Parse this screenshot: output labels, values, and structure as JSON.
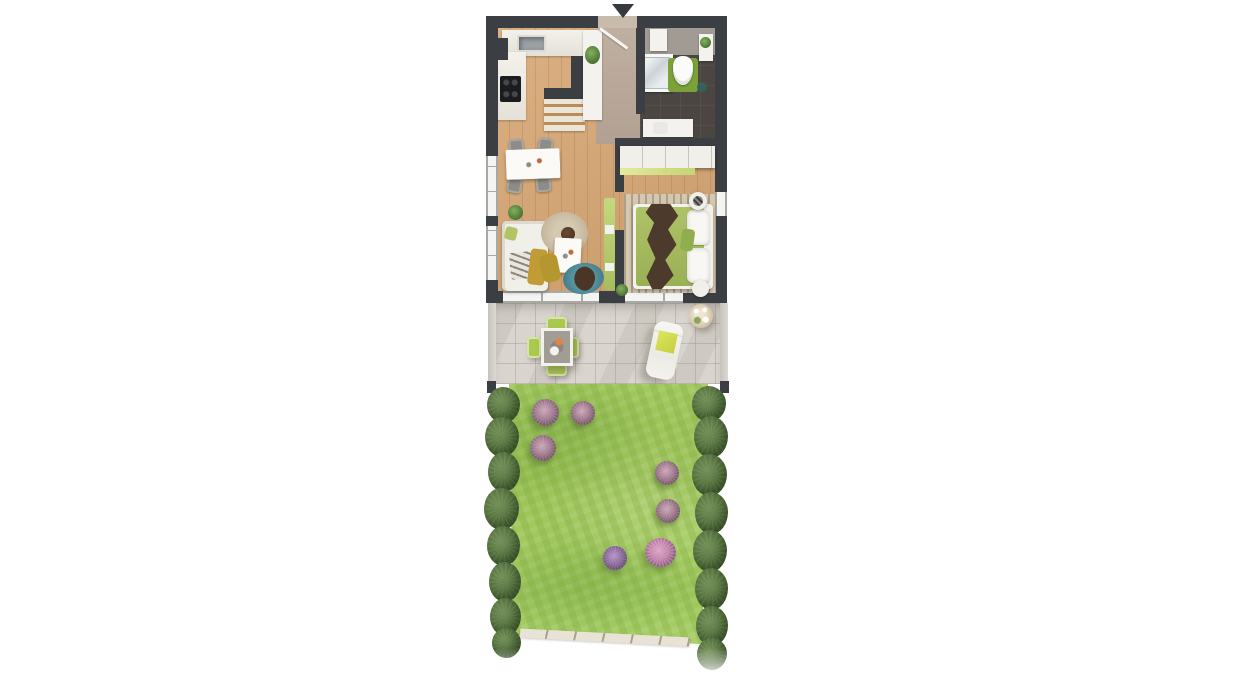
{
  "meta": {
    "kind": "floor-plan-render",
    "visible_text": "none",
    "canvas": {
      "width": 1236,
      "height": 700,
      "background": "#ffffff"
    }
  },
  "palette": {
    "wall": "#3b3e42",
    "wood_floor": "#d8a875",
    "bedroom_floor": "#d0a06c",
    "hall_floor": "#b7a697",
    "bathroom_floor": "#4b4641",
    "terrace_tile": "#d9d5ce",
    "grass": "#a0c65c",
    "hedge": "#587540",
    "accent_green": "#abc94e",
    "bed_green": "#a9c063",
    "mat_green": "#7aa238",
    "teal_rug": "#4f8b96",
    "mustard": "#c19b35"
  },
  "plan": {
    "rooms": [
      {
        "name": "kitchen"
      },
      {
        "name": "hallway"
      },
      {
        "name": "bathroom"
      },
      {
        "name": "living-room"
      },
      {
        "name": "bedroom"
      },
      {
        "name": "terrace"
      },
      {
        "name": "garden"
      }
    ],
    "elements": [
      {
        "name": "floor-living-kitchen",
        "cls": "wood",
        "x": 496,
        "y": 24,
        "w": 128,
        "h": 269
      },
      {
        "name": "floor-hall",
        "cls": "hall-floor",
        "x": 596,
        "y": 24,
        "w": 48,
        "h": 120
      },
      {
        "name": "floor-bathroom",
        "cls": "bath-floor",
        "x": 640,
        "y": 24,
        "w": 77,
        "h": 122
      },
      {
        "name": "bathroom-wall-band",
        "x": 640,
        "y": 24,
        "w": 77,
        "h": 31,
        "bg": "#a19b94"
      },
      {
        "name": "floor-bedroom",
        "cls": "wood wood-dark",
        "x": 619,
        "y": 140,
        "w": 98,
        "h": 152
      },
      {
        "name": "kitchen-counter",
        "cls": "counter",
        "x": 502,
        "y": 30,
        "w": 84,
        "h": 26
      },
      {
        "name": "kitchen-sink",
        "cls": "sink",
        "x": 517,
        "y": 35,
        "w": 29,
        "h": 17
      },
      {
        "name": "kitchen-counter-left",
        "cls": "counter",
        "x": 496,
        "y": 52,
        "w": 30,
        "h": 68
      },
      {
        "name": "kitchen-cooktop",
        "cls": "cooktop",
        "x": 500,
        "y": 76,
        "w": 21,
        "h": 26
      },
      {
        "name": "kitchen-halfwall-v",
        "cls": "wall",
        "x": 571,
        "y": 56,
        "w": 12,
        "h": 42
      },
      {
        "name": "kitchen-halfwall-h",
        "cls": "wall",
        "x": 544,
        "y": 88,
        "w": 39,
        "h": 11
      },
      {
        "name": "kitchen-sideboard",
        "cls": "sideboard",
        "x": 544,
        "y": 99,
        "w": 41,
        "h": 32
      },
      {
        "name": "kitchen-tall-cabinet",
        "cls": "white",
        "x": 583,
        "y": 30,
        "w": 19,
        "h": 90
      },
      {
        "name": "kitchen-plant",
        "cls": "plant",
        "x": 585,
        "y": 46,
        "w": 15,
        "h": 18
      },
      {
        "name": "bath-panel",
        "cls": "white",
        "x": 650,
        "y": 29,
        "w": 17,
        "h": 22
      },
      {
        "name": "shower",
        "cls": "shower",
        "x": 640,
        "y": 54,
        "w": 33,
        "h": 38
      },
      {
        "name": "toilet-mat",
        "x": 668,
        "y": 58,
        "w": 30,
        "h": 34,
        "bg": "#7aa238",
        "br": "3px"
      },
      {
        "name": "toilet",
        "cls": "toilet",
        "x": 673,
        "y": 56,
        "w": 20,
        "h": 29
      },
      {
        "name": "bath-shelf",
        "cls": "white",
        "x": 699,
        "y": 34,
        "w": 14,
        "h": 27
      },
      {
        "name": "bath-shelf-plant",
        "cls": "plant",
        "x": 700,
        "y": 37,
        "w": 11,
        "h": 11
      },
      {
        "name": "bath-bin",
        "x": 697,
        "y": 82,
        "w": 10,
        "h": 10,
        "bg": "#35605c",
        "br": "50%"
      },
      {
        "name": "bath-vanity",
        "cls": "white",
        "x": 643,
        "y": 119,
        "w": 50,
        "h": 18
      },
      {
        "name": "bath-basin",
        "x": 653,
        "y": 122,
        "w": 15,
        "h": 12,
        "bg": "#e9e8e4",
        "br": "3px"
      },
      {
        "name": "wall-top-left",
        "cls": "wall",
        "x": 486,
        "y": 16,
        "w": 112,
        "h": 12
      },
      {
        "name": "wall-top-right",
        "cls": "wall",
        "x": 637,
        "y": 16,
        "w": 90,
        "h": 12
      },
      {
        "name": "wall-left",
        "cls": "wall",
        "x": 486,
        "y": 16,
        "w": 12,
        "h": 287
      },
      {
        "name": "wall-corner-notch",
        "cls": "wall",
        "x": 486,
        "y": 38,
        "w": 22,
        "h": 22
      },
      {
        "name": "wall-right",
        "cls": "wall",
        "x": 715,
        "y": 16,
        "w": 12,
        "h": 287
      },
      {
        "name": "wall-bottom-left",
        "cls": "wall",
        "x": 486,
        "y": 291,
        "w": 17,
        "h": 12
      },
      {
        "name": "wall-bottom-mid",
        "cls": "wall",
        "x": 599,
        "y": 291,
        "w": 26,
        "h": 12
      },
      {
        "name": "wall-bottom-right",
        "cls": "wall",
        "x": 683,
        "y": 291,
        "w": 44,
        "h": 12
      },
      {
        "name": "wall-hall-bathroom",
        "cls": "wall",
        "x": 636,
        "y": 24,
        "w": 9,
        "h": 90
      },
      {
        "name": "wall-bathroom-bottom",
        "cls": "wall",
        "x": 615,
        "y": 138,
        "w": 112,
        "h": 10
      },
      {
        "name": "wall-divider-upper",
        "cls": "wall",
        "x": 615,
        "y": 148,
        "w": 9,
        "h": 44
      },
      {
        "name": "wall-divider-lower",
        "cls": "wall",
        "x": 615,
        "y": 230,
        "w": 9,
        "h": 61
      },
      {
        "name": "window-left-upper",
        "cls": "window-v",
        "x": 486,
        "y": 156,
        "w": 12,
        "h": 60
      },
      {
        "name": "window-left-lower",
        "cls": "window-v",
        "x": 486,
        "y": 226,
        "w": 12,
        "h": 54
      },
      {
        "name": "window-right-bedroom",
        "cls": "window-v",
        "x": 715,
        "y": 192,
        "w": 12,
        "h": 24
      },
      {
        "name": "window-terrace-left",
        "cls": "window-h",
        "x": 503,
        "y": 291,
        "w": 96,
        "h": 12
      },
      {
        "name": "window-terrace-right",
        "cls": "window-h",
        "x": 625,
        "y": 291,
        "w": 58,
        "h": 12
      },
      {
        "name": "entry-opening",
        "x": 598,
        "y": 16,
        "w": 39,
        "h": 12,
        "bg": "#c9bbac"
      },
      {
        "name": "entry-door-leaf",
        "cls": "door-leaf",
        "x": 600,
        "y": 27,
        "w": 34,
        "h": 3,
        "rot": 36
      },
      {
        "name": "entrance-arrow",
        "cls": "arrow",
        "x": 612,
        "y": 4,
        "w": 0,
        "h": 0
      },
      {
        "name": "dining-chair-1",
        "cls": "chair",
        "x": 509,
        "y": 139,
        "w": 15,
        "h": 16,
        "rot": -8
      },
      {
        "name": "dining-chair-2",
        "cls": "chair",
        "x": 538,
        "y": 138,
        "w": 15,
        "h": 16,
        "rot": 6
      },
      {
        "name": "dining-chair-3",
        "cls": "chair",
        "x": 507,
        "y": 177,
        "w": 15,
        "h": 16,
        "rot": 10
      },
      {
        "name": "dining-chair-4",
        "cls": "chair",
        "x": 536,
        "y": 176,
        "w": 15,
        "h": 16,
        "rot": -6
      },
      {
        "name": "dining-table",
        "cls": "table-white",
        "x": 506,
        "y": 149,
        "w": 54,
        "h": 30,
        "rot": -2
      },
      {
        "name": "living-plant",
        "cls": "plant",
        "x": 508,
        "y": 205,
        "w": 15,
        "h": 15
      },
      {
        "name": "sofa",
        "cls": "sofa",
        "x": 502,
        "y": 221,
        "w": 46,
        "h": 70
      },
      {
        "name": "sofa-pillow-green",
        "x": 505,
        "y": 227,
        "w": 12,
        "h": 13,
        "bg": "#b3c464",
        "br": "3px",
        "rot": 14
      },
      {
        "name": "sofa-throw-zigzag",
        "cls": "zigzag",
        "x": 510,
        "y": 252,
        "w": 23,
        "h": 27,
        "rot": -5
      },
      {
        "name": "sofa-blanket-mustard",
        "x": 529,
        "y": 249,
        "w": 17,
        "h": 36,
        "bg": "#c19b35",
        "br": "4px",
        "rot": 7
      },
      {
        "name": "rug-round",
        "cls": "rug-round",
        "x": 541,
        "y": 212,
        "w": 47,
        "h": 42
      },
      {
        "name": "rug-round-bowl",
        "x": 561,
        "y": 227,
        "w": 14,
        "h": 14,
        "br": "50%",
        "bg": "radial-gradient(circle at 40% 40%, #6b4a33, #452d1e)"
      },
      {
        "name": "coffee-table",
        "cls": "table-white",
        "x": 554,
        "y": 238,
        "w": 27,
        "h": 35,
        "rot": 3
      },
      {
        "name": "pouf-yellow",
        "x": 541,
        "y": 254,
        "w": 18,
        "h": 28,
        "bg": "#b5972f",
        "br": "6px",
        "rot": -12
      },
      {
        "name": "rug-teal",
        "x": 563,
        "y": 263,
        "w": 41,
        "h": 31,
        "br": "50%",
        "rot": -8,
        "bg": "radial-gradient(circle, #57939e 45%, #417c88 80%, #356a76 100%)"
      },
      {
        "name": "rug-teal-object",
        "x": 574,
        "y": 267,
        "w": 21,
        "h": 23,
        "bg": "#4a3526",
        "br": "45% 55% 40% 60%",
        "rot": 28
      },
      {
        "name": "tv-sideboard",
        "x": 604,
        "y": 198,
        "w": 11,
        "h": 92,
        "bg": "linear-gradient(180deg,#c6d87f,#a6bd5e)",
        "br": "2px"
      },
      {
        "name": "tv-sideboard-shelf-1",
        "x": 605,
        "y": 225,
        "w": 9,
        "h": 9,
        "bg": "#f2f1ec"
      },
      {
        "name": "tv-sideboard-shelf-2",
        "x": 605,
        "y": 263,
        "w": 9,
        "h": 8,
        "bg": "#f2f1ec"
      },
      {
        "name": "bedroom-rug",
        "cls": "rug-striped",
        "x": 624,
        "y": 194,
        "w": 92,
        "h": 99
      },
      {
        "name": "wardrobe",
        "cls": "wardrobe",
        "x": 620,
        "y": 146,
        "w": 95,
        "h": 22
      },
      {
        "name": "wardrobe-accent",
        "x": 620,
        "y": 168,
        "w": 75,
        "h": 7,
        "bg": "linear-gradient(90deg,#e3ea9e,#c4d475)"
      },
      {
        "name": "bed",
        "cls": "bed",
        "x": 633,
        "y": 204,
        "w": 80,
        "h": 85
      },
      {
        "name": "bed-spread",
        "x": 636,
        "y": 207,
        "w": 68,
        "h": 79,
        "bg": "linear-gradient(180deg,#aec268,#9ab055)",
        "br": "3px"
      },
      {
        "name": "bed-pillow-1",
        "cls": "pillow",
        "x": 687,
        "y": 210,
        "w": 23,
        "h": 35
      },
      {
        "name": "bed-pillow-2",
        "cls": "pillow",
        "x": 687,
        "y": 248,
        "w": 23,
        "h": 35
      },
      {
        "name": "bed-cushion-green",
        "x": 681,
        "y": 229,
        "w": 13,
        "h": 22,
        "bg": "#8fae4e",
        "br": "4px",
        "rot": 8
      },
      {
        "name": "bed-throw",
        "cls": "throw",
        "x": 645,
        "y": 204,
        "w": 35,
        "h": 85
      },
      {
        "name": "nightstand-1",
        "cls": "shadow-sm",
        "x": 689,
        "y": 192,
        "w": 18,
        "h": 18,
        "bg": "#f1efea",
        "br": "50%"
      },
      {
        "name": "nightstand-1-deco",
        "x": 693,
        "y": 196,
        "w": 10,
        "h": 10,
        "br": "50%",
        "bg": "repeating-linear-gradient(45deg,#3d3a36 0 2px,#8a867f 2px 4px)"
      },
      {
        "name": "nightstand-2",
        "cls": "shadow-sm",
        "x": 692,
        "y": 280,
        "w": 17,
        "h": 17,
        "bg": "#f1efea",
        "br": "50%"
      },
      {
        "name": "bedroom-plant",
        "cls": "plant",
        "x": 616,
        "y": 284,
        "w": 12,
        "h": 12
      },
      {
        "name": "terrace",
        "cls": "tile",
        "x": 495,
        "y": 303,
        "w": 226,
        "h": 81
      },
      {
        "name": "terrace-fence-left",
        "cls": "fence",
        "x": 488,
        "y": 303,
        "w": 8,
        "h": 79
      },
      {
        "name": "terrace-fence-right",
        "cls": "fence",
        "x": 720,
        "y": 303,
        "w": 8,
        "h": 79
      },
      {
        "name": "fence-post-left",
        "cls": "wall",
        "x": 487,
        "y": 381,
        "w": 9,
        "h": 12
      },
      {
        "name": "fence-post-right",
        "cls": "wall",
        "x": 720,
        "y": 381,
        "w": 9,
        "h": 12
      },
      {
        "name": "patio-chair-top",
        "cls": "patio-chair",
        "x": 546,
        "y": 317,
        "w": 21,
        "h": 14
      },
      {
        "name": "patio-chair-bottom",
        "cls": "patio-chair",
        "x": 546,
        "y": 362,
        "w": 21,
        "h": 14
      },
      {
        "name": "patio-chair-left",
        "cls": "patio-chair",
        "x": 527,
        "y": 337,
        "w": 14,
        "h": 21
      },
      {
        "name": "patio-chair-right",
        "cls": "patio-chair",
        "x": 565,
        "y": 337,
        "w": 14,
        "h": 21
      },
      {
        "name": "patio-table",
        "cls": "patio-table",
        "x": 541,
        "y": 328,
        "w": 32,
        "h": 38
      },
      {
        "name": "sun-lounger",
        "cls": "lounger",
        "x": 650,
        "y": 322,
        "w": 29,
        "h": 57,
        "rot": 12
      },
      {
        "name": "lounger-towel",
        "x": 657,
        "y": 332,
        "w": 19,
        "h": 20,
        "bg": "linear-gradient(135deg,#dde65f,#c3cf3f)",
        "rot": 12
      },
      {
        "name": "terrace-potted-plant",
        "cls": "terrace-plant",
        "x": 689,
        "y": 304,
        "w": 24,
        "h": 24
      },
      {
        "name": "garden-grass",
        "cls": "grass",
        "x": 505,
        "y": 384,
        "w": 204,
        "h": 260,
        "clip": "polygon(2% 0%, 99.5% 0%, 96.5% 100%, 4% 96.5%)"
      },
      {
        "name": "garden-curb",
        "cls": "curb",
        "x": 520,
        "y": 633,
        "w": 170,
        "h": 9,
        "rot": 3
      },
      {
        "name": "hedge-left-1",
        "cls": "hedge-blob",
        "x": 487,
        "y": 387,
        "w": 33,
        "h": 36
      },
      {
        "name": "hedge-left-2",
        "cls": "hedge-blob",
        "x": 485,
        "y": 417,
        "w": 34,
        "h": 40
      },
      {
        "name": "hedge-left-3",
        "cls": "hedge-blob",
        "x": 488,
        "y": 452,
        "w": 32,
        "h": 40
      },
      {
        "name": "hedge-left-4",
        "cls": "hedge-blob",
        "x": 484,
        "y": 488,
        "w": 35,
        "h": 42
      },
      {
        "name": "hedge-left-5",
        "cls": "hedge-blob",
        "x": 487,
        "y": 526,
        "w": 33,
        "h": 40
      },
      {
        "name": "hedge-left-6",
        "cls": "hedge-blob",
        "x": 489,
        "y": 562,
        "w": 32,
        "h": 40
      },
      {
        "name": "hedge-left-7",
        "cls": "hedge-blob",
        "x": 490,
        "y": 598,
        "w": 31,
        "h": 38
      },
      {
        "name": "hedge-left-8",
        "cls": "hedge-blob",
        "x": 492,
        "y": 628,
        "w": 29,
        "h": 30
      },
      {
        "name": "hedge-right-1",
        "cls": "hedge-blob",
        "x": 692,
        "y": 386,
        "w": 34,
        "h": 36
      },
      {
        "name": "hedge-right-2",
        "cls": "hedge-blob",
        "x": 694,
        "y": 416,
        "w": 34,
        "h": 42
      },
      {
        "name": "hedge-right-3",
        "cls": "hedge-blob",
        "x": 692,
        "y": 454,
        "w": 35,
        "h": 42
      },
      {
        "name": "hedge-right-4",
        "cls": "hedge-blob",
        "x": 695,
        "y": 492,
        "w": 33,
        "h": 42
      },
      {
        "name": "hedge-right-5",
        "cls": "hedge-blob",
        "x": 693,
        "y": 530,
        "w": 34,
        "h": 42
      },
      {
        "name": "hedge-right-6",
        "cls": "hedge-blob",
        "x": 695,
        "y": 568,
        "w": 33,
        "h": 42
      },
      {
        "name": "hedge-right-7",
        "cls": "hedge-blob",
        "x": 696,
        "y": 606,
        "w": 32,
        "h": 40
      },
      {
        "name": "hedge-right-8",
        "cls": "hedge-blob",
        "x": 697,
        "y": 638,
        "w": 30,
        "h": 32
      },
      {
        "name": "flower-bush-1",
        "cls": "flower-bush",
        "x": 532,
        "y": 399,
        "w": 27,
        "h": 27
      },
      {
        "name": "flower-bush-2",
        "cls": "flower-bush",
        "x": 571,
        "y": 401,
        "w": 24,
        "h": 24
      },
      {
        "name": "flower-bush-3",
        "cls": "flower-bush",
        "x": 530,
        "y": 435,
        "w": 26,
        "h": 26
      },
      {
        "name": "flower-bush-4",
        "cls": "flower-bush",
        "x": 655,
        "y": 461,
        "w": 24,
        "h": 24
      },
      {
        "name": "flower-bush-5",
        "cls": "flower-bush",
        "x": 656,
        "y": 499,
        "w": 24,
        "h": 24
      },
      {
        "name": "flower-bush-6",
        "cls": "flower-bush purple",
        "x": 603,
        "y": 546,
        "w": 24,
        "h": 24
      },
      {
        "name": "flower-bush-7",
        "cls": "flower-bush pink",
        "x": 645,
        "y": 538,
        "w": 31,
        "h": 29
      },
      {
        "name": "bottom-white-fade",
        "x": 478,
        "y": 648,
        "w": 262,
        "h": 42,
        "bg": "linear-gradient(180deg, rgba(255,255,255,0), rgba(255,255,255,1) 70%)"
      }
    ]
  }
}
